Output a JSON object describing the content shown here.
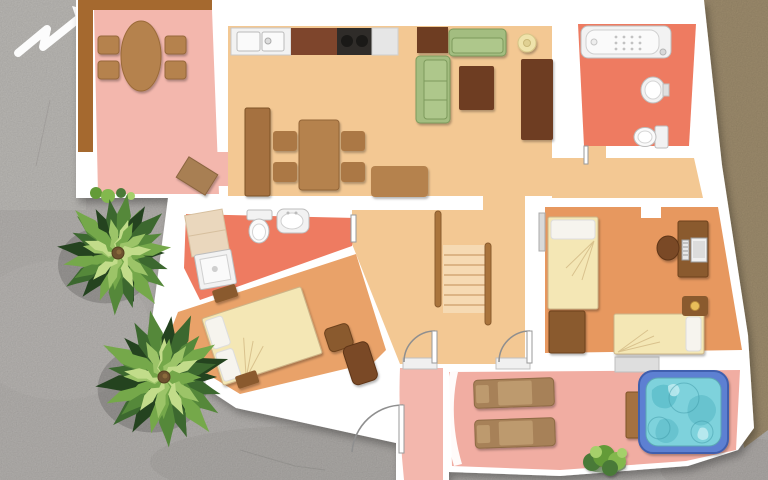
{
  "scene": {
    "type": "apartment-floor-plan-top-view",
    "compass_arrow_direction": "upper-right",
    "palm_tree_count": 2,
    "bed_count": 3,
    "bathroom_count": 2,
    "sun_lounger_count": 2,
    "has_jacuzzi": true,
    "has_stairs": true
  },
  "palette": {
    "concrete": "#b8b5b2",
    "concreteLight": "#c7c4c1",
    "concreteDark": "#a29f9c",
    "khaki": "#a29070",
    "wall": "#ffffff",
    "terracePink": "#f3b7ad",
    "terracePinkDeep": "#f1ada2",
    "tanFloor": "#f3c893",
    "coral": "#ee7b61",
    "orangeFloor": "#e9a269",
    "orangeFloorDeep": "#e7985f",
    "deckBrown": "#a5692f",
    "furnLight": "#b5824e",
    "furnMid": "#8a5a2e",
    "furnDark": "#6e3c22",
    "furnChaise": "#7a4a28",
    "counterBrown": "#7e452c",
    "stove": "#2f2c29",
    "sofaGreen": "#a3bd80",
    "sofaGreenLight": "#aec78b",
    "sofaSeam": "#7d9a5b",
    "bedCream": "#f4e7b5",
    "bedFold": "#d9c28d",
    "pillow": "#f6f4ee",
    "stairFill": "#f6dab3",
    "stairLine": "#d3a876",
    "rail": "#a9743c",
    "fixture": "#f2f2f2",
    "fixtureInner": "#fafafa",
    "fixtureStroke": "#bdbdbd",
    "matBeige": "#ead7bd",
    "lounger": "#a78158",
    "loungerCushion": "#bd9a6e",
    "jacuzziFrame": "#5d80d2",
    "water": "#7ed2dc",
    "waterDark": "#4fb4c2",
    "waterLight": "#c4eef2",
    "knobGold": "#e9bd5a",
    "lampCream": "#efe3ab",
    "stepGray": "#dedede",
    "sill": "#f0f0f0",
    "window": "#d9d9d9",
    "arrowWhite": "#fcfcfc",
    "doorStroke": "#8f8f8f",
    "palmGreens": [
      "#24431f",
      "#3c682f",
      "#55883a",
      "#75a84a",
      "#9cc468",
      "#c2dc8a"
    ],
    "palmTrunk": "#6e5230",
    "bush": [
      "#2f5520",
      "#4a7a38",
      "#639b38",
      "#83b84e",
      "#a5d06a"
    ]
  },
  "palms": [
    {
      "cx": 118,
      "cy": 253,
      "r": 60,
      "fronds": 24
    },
    {
      "cx": 164,
      "cy": 377,
      "r": 68,
      "fronds": 26
    }
  ]
}
